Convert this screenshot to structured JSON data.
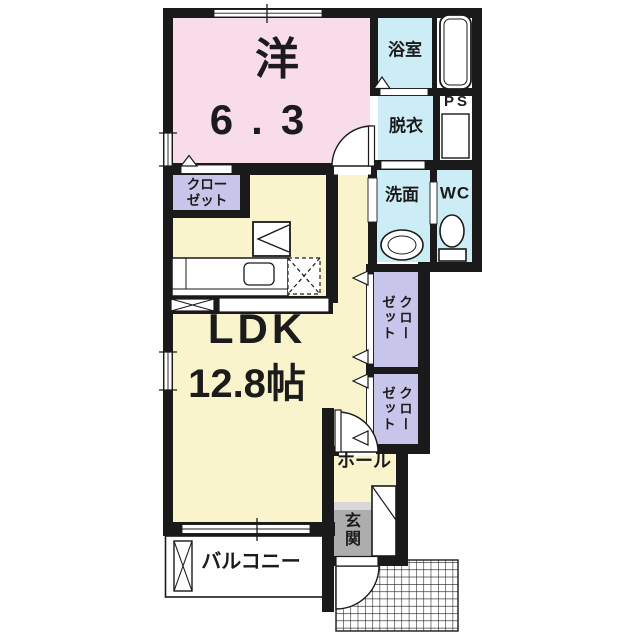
{
  "plan_title": "1LDK apartment floor plan",
  "colors": {
    "wall": "#1a1a1a",
    "western_room": "#f9dce9",
    "ldk": "#faf4cc",
    "wet_area": "#cdedf6",
    "closet": "#c7c5ea",
    "entrance_floor": "#adadad",
    "entrance_step": "#d8d8d8"
  },
  "rooms": {
    "western": {
      "label": "洋",
      "size": "6.3"
    },
    "bathroom": {
      "label": "浴室"
    },
    "dressing": {
      "label": "脱衣"
    },
    "pipe_space": {
      "label": "PS"
    },
    "washroom": {
      "label": "洗面"
    },
    "wc": {
      "label": "WC"
    },
    "closet_upper": {
      "line1": "クロー",
      "line2": "ゼット"
    },
    "ldk": {
      "label": "LDK",
      "size": "12.8帖"
    },
    "closet_a": {
      "label": "クローゼット"
    },
    "closet_b": {
      "label": "クローゼット"
    },
    "hall": {
      "label": "ホール"
    },
    "entrance": {
      "label": "玄関"
    },
    "balcony": {
      "label": "バルコニー"
    }
  }
}
